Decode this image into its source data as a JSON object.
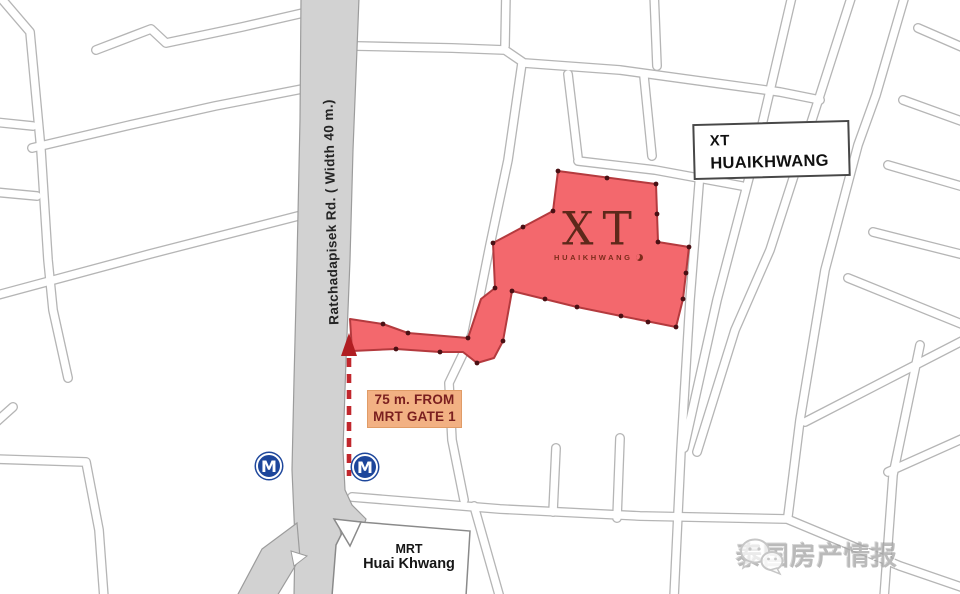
{
  "map": {
    "road": {
      "label": "Ratchadapisek Rd.  ( Width 40 m.)"
    },
    "project_box": {
      "line1": "XT",
      "line2": "HUAIKHWANG"
    },
    "site_logo": {
      "main": "XT",
      "sub": "HUAIKHWANG"
    },
    "distance_callout": {
      "line1": "75 m. FROM",
      "line2": "MRT GATE 1"
    },
    "station": {
      "line1": "MRT",
      "line2": "Huai Khwang"
    },
    "mrt_markers": [
      {
        "letter": "M"
      },
      {
        "letter": "M"
      }
    ],
    "watermark": {
      "text": "泰国房产情报",
      "icon": "wechat-bubbles-icon"
    },
    "colors": {
      "site_fill": "#f3686d",
      "site_border": "#b43a3e",
      "vertex_dot": "#4a1014",
      "arrow_red": "#c1272d",
      "callout_bg": "#f2b183",
      "callout_text": "#7a1f1f",
      "mrt_blue": "#1d469b",
      "road_gray": "#d2d2d2",
      "road_edge": "#9c9c9c",
      "street_line": "#b5b5b5"
    }
  }
}
